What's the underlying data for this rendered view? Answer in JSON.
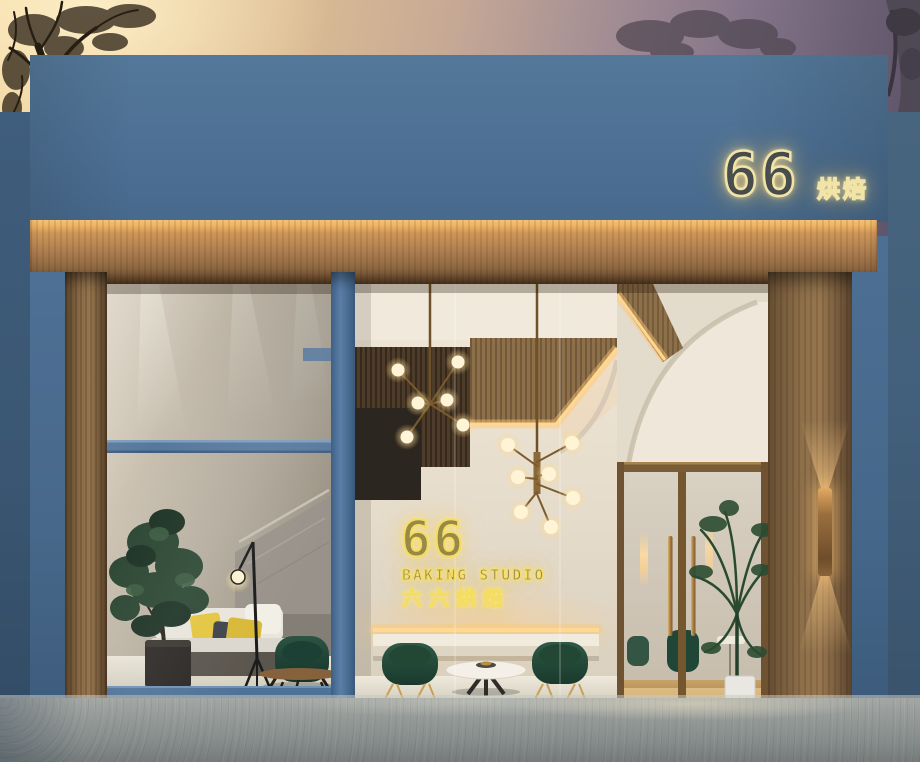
{
  "scene": {
    "type": "exterior-architectural-render",
    "time_of_day": "dusk",
    "storefront_name": "66 Baking Studio"
  },
  "signs": {
    "parapet_sign": {
      "number": "66",
      "cn": "烘焙"
    },
    "neon_wall_sign": {
      "number": "66",
      "en": "BAKING STUDIO",
      "cn": "六六烘焙"
    }
  },
  "palette": {
    "facade_blue": "#4d6f93",
    "awning_wood": "#a8835a",
    "neon_yellow": "#f4dd62",
    "chair_green": "#235040",
    "pillow_yellow": "#e4c33c",
    "interior_warm_white": "#e8e0d1",
    "brass": "#c8a057",
    "sidewalk_grey": "#8e9394",
    "sky_orange": "#eecf9a",
    "sky_purple": "#6b5f73"
  }
}
